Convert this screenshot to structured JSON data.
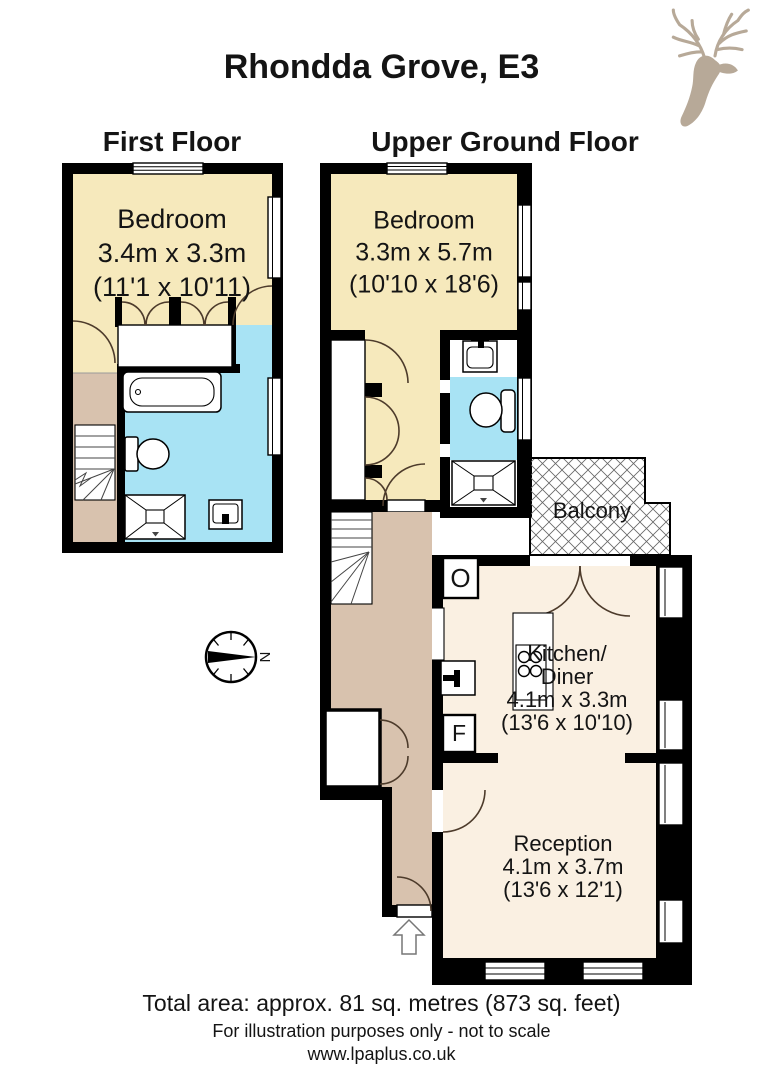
{
  "title": "Rhondda Grove, E3",
  "floors": {
    "first": {
      "label": "First Floor",
      "bedroom": {
        "name": "Bedroom",
        "metric": "3.4m x 3.3m",
        "imperial": "(11'1 x 10'11)"
      }
    },
    "upper_ground": {
      "label": "Upper Ground Floor",
      "bedroom": {
        "name": "Bedroom",
        "metric": "3.3m x 5.7m",
        "imperial": "(10'10 x 18'6)"
      },
      "balcony": {
        "name": "Balcony"
      },
      "kitchen_diner": {
        "line1": "Kitchen/",
        "line2": "Diner",
        "metric": "4.1m x 3.3m",
        "imperial": "(13'6 x 10'10)"
      },
      "reception": {
        "name": "Reception",
        "metric": "4.1m x 3.7m",
        "imperial": "(13'6 x 12'1)"
      },
      "oven_label": "O",
      "fridge_label": "F"
    }
  },
  "compass": {
    "north_label": "N"
  },
  "footer": {
    "total_area": "Total area: approx. 81 sq. metres (873 sq. feet)",
    "disclaimer": "For illustration purposes only - not to scale",
    "website": "www.lpaplus.co.uk"
  },
  "colors": {
    "wall": "#000000",
    "cream": "#F6E9BC",
    "offwhite": "#FAF0E2",
    "blue": "#A8E3F4",
    "tan": "#D8C2AE",
    "arc": "#4D3B2B",
    "logo": "#B7A998",
    "hatch": "#666666"
  }
}
